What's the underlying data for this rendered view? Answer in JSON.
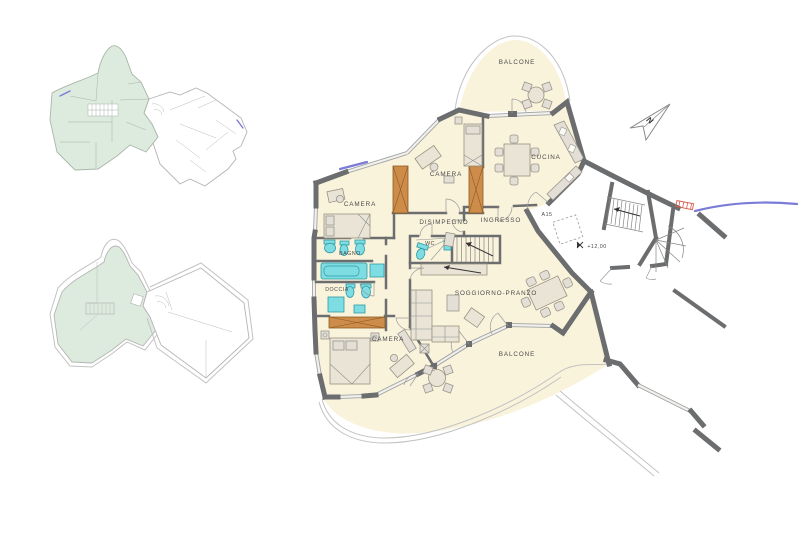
{
  "main_plan": {
    "rooms": {
      "balcone_top": {
        "label": "BALCONE"
      },
      "cucina": {
        "label": "CUCINA"
      },
      "camera_top": {
        "label": "CAMERA"
      },
      "camera_left": {
        "label": "CAMERA"
      },
      "camera_bottom": {
        "label": "CAMERA"
      },
      "disimpegno": {
        "label": "DISIMPEGNO"
      },
      "ingresso": {
        "label": "INGRESSO"
      },
      "bagno": {
        "label": "BAGNO"
      },
      "doccia": {
        "label": "DOCCIA"
      },
      "wc": {
        "label": "WC"
      },
      "soggiorno_pranzo": {
        "label": "SOGGIORNO-PRANZO"
      },
      "balcone_bottom": {
        "label": "BALCONE"
      }
    },
    "annotations": {
      "apartment_code": "A15",
      "elevation_marker": "+12,00",
      "north_indicator": "N"
    }
  },
  "colors": {
    "floor_fill": "#FAF3DC",
    "wall": "#6B6D6F",
    "fixture_cyan": "#7EDDE2",
    "wardrobe_orange": "#CE8C4B",
    "key_plan_highlight": "#DCEBDD",
    "accent_blue": "#7B7BD8",
    "accent_red": "#D95B4A"
  }
}
